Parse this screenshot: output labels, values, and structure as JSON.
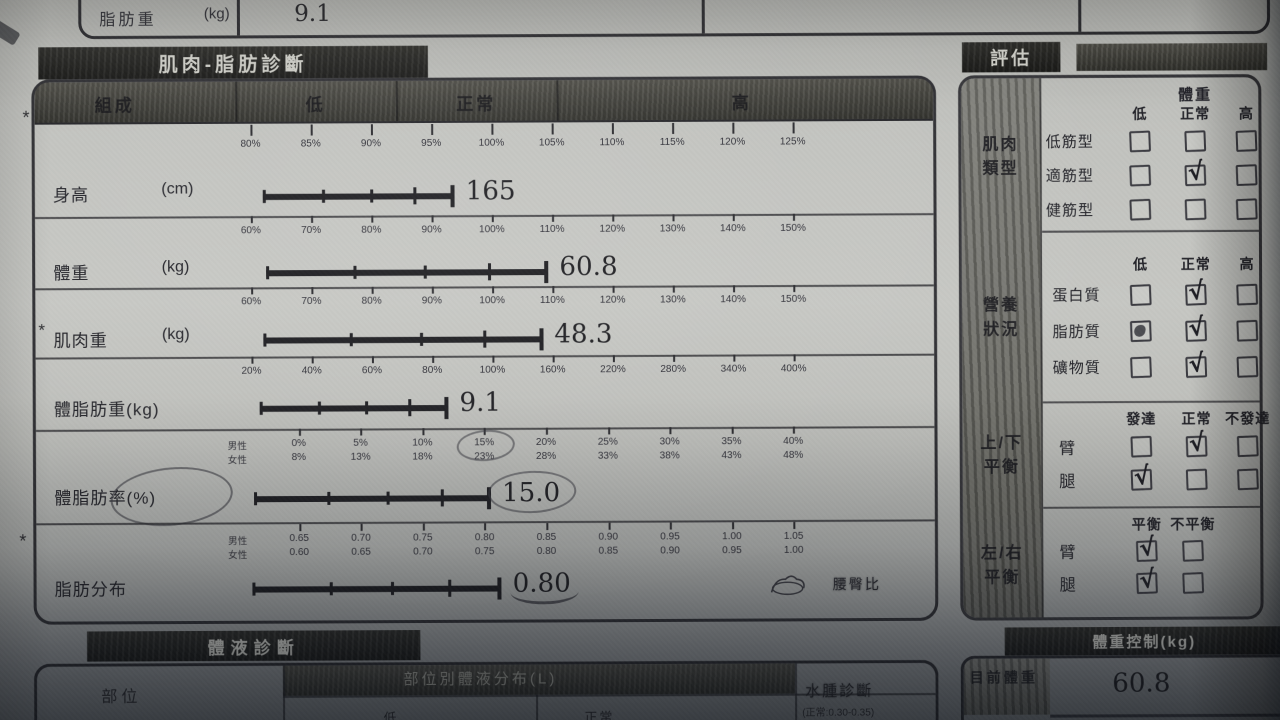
{
  "colors": {
    "paper": "#c4c5c1",
    "band": "#2a2a27",
    "ink": "#222226",
    "check_ink": "#1e1e24"
  },
  "margin_stars": [
    "*",
    "*"
  ],
  "top_row": {
    "label": "脂肪重",
    "unit": "(kg)",
    "value": "9.1"
  },
  "muscle_fat": {
    "tab_title": "肌肉-脂肪診斷",
    "header_cols": [
      "組成",
      "低",
      "正常",
      "高"
    ],
    "rows": [
      {
        "label": "身高",
        "unit": "(cm)",
        "value": "165",
        "scales": [
          {
            "prefix": "",
            "ticks": [
              "80%",
              "85%",
              "90%",
              "95%",
              "100%",
              "105%",
              "110%",
              "115%",
              "120%",
              "125%"
            ]
          }
        ],
        "bar": {
          "start": 7,
          "end": 38.7
        }
      },
      {
        "label": "體重",
        "unit": "(kg)",
        "value": "60.8",
        "scales": [
          {
            "prefix": "",
            "ticks": [
              "60%",
              "70%",
              "80%",
              "90%",
              "100%",
              "110%",
              "120%",
              "130%",
              "140%",
              "150%"
            ]
          }
        ],
        "bar": {
          "start": 7.5,
          "end": 54.2
        }
      },
      {
        "label": "肌肉重",
        "unit": "(kg)",
        "value": "48.3",
        "star": "*",
        "scales": [
          {
            "prefix": "",
            "ticks": [
              "60%",
              "70%",
              "80%",
              "90%",
              "100%",
              "110%",
              "120%",
              "130%",
              "140%",
              "150%"
            ]
          }
        ],
        "bar": {
          "start": 7,
          "end": 53.3
        }
      },
      {
        "label": "體脂肪重(kg)",
        "unit": "",
        "value": "9.1",
        "scales": [
          {
            "prefix": "",
            "ticks": [
              "20%",
              "40%",
              "60%",
              "80%",
              "100%",
              "160%",
              "220%",
              "280%",
              "340%",
              "400%"
            ]
          }
        ],
        "bar": {
          "start": 6.3,
          "end": 37.5
        }
      },
      {
        "label": "體脂肪率(%)",
        "unit": "",
        "value": "15.0",
        "label_circled": true,
        "value_circled": true,
        "scales": [
          {
            "prefix": "男性",
            "circled": 3,
            "ticks": [
              "0%",
              "5%",
              "10%",
              "15%",
              "20%",
              "25%",
              "30%",
              "35%",
              "40%"
            ]
          },
          {
            "prefix": "女性",
            "ticks": [
              "8%",
              "13%",
              "18%",
              "23%",
              "28%",
              "33%",
              "38%",
              "43%",
              "48%"
            ]
          }
        ],
        "bar": {
          "start": 5.3,
          "end": 44.5
        }
      },
      {
        "label": "脂肪分布",
        "unit": "",
        "value": "0.80",
        "value_underlined": true,
        "trailing_label": "腰臀比",
        "scales": [
          {
            "prefix": "男性",
            "ticks": [
              "0.65",
              "0.70",
              "0.75",
              "0.80",
              "0.85",
              "0.90",
              "0.95",
              "1.00",
              "1.05"
            ]
          },
          {
            "prefix": "女性",
            "ticks": [
              "0.60",
              "0.65",
              "0.70",
              "0.75",
              "0.80",
              "0.85",
              "0.90",
              "0.95",
              "1.00"
            ]
          }
        ],
        "bar": {
          "start": 5,
          "end": 46.2
        }
      }
    ]
  },
  "evaluation": {
    "tab_title": "評估",
    "check_glyph": "√",
    "sections": [
      {
        "side_label": [
          "肌肉",
          "類型"
        ],
        "super_header": "體重",
        "columns": [
          "低",
          "正常",
          "高"
        ],
        "rows": [
          {
            "label": "低筋型",
            "cells": [
              "empty",
              "empty",
              "empty"
            ]
          },
          {
            "label": "適筋型",
            "cells": [
              "empty",
              "check",
              "empty"
            ]
          },
          {
            "label": "健筋型",
            "cells": [
              "empty",
              "empty",
              "empty"
            ]
          }
        ]
      },
      {
        "side_label": [
          "營養",
          "狀況"
        ],
        "columns": [
          "低",
          "正常",
          "高"
        ],
        "rows": [
          {
            "label": "蛋白質",
            "cells": [
              "empty",
              "check",
              "empty"
            ]
          },
          {
            "label": "脂肪質",
            "cells": [
              "smudge",
              "check",
              "empty"
            ]
          },
          {
            "label": "礦物質",
            "cells": [
              "empty",
              "check",
              "empty"
            ]
          }
        ]
      },
      {
        "side_label": [
          "上/下",
          "平衡"
        ],
        "columns": [
          "發達",
          "正常",
          "不發達"
        ],
        "rows": [
          {
            "label": "臂",
            "cells": [
              "empty",
              "check",
              "empty"
            ]
          },
          {
            "label": "腿",
            "cells": [
              "check",
              "empty",
              "empty"
            ]
          }
        ]
      },
      {
        "side_label": [
          "左/右",
          "平衡"
        ],
        "columns": [
          "平衡",
          "不平衡"
        ],
        "rows": [
          {
            "label": "臂",
            "cells": [
              "check",
              "empty"
            ]
          },
          {
            "label": "腿",
            "cells": [
              "check",
              "empty"
            ]
          }
        ]
      }
    ]
  },
  "body_fluid": {
    "tab_title": "體液診斷",
    "col_part": "部位",
    "col_distribution": "部位別體液分布(L)",
    "sub_cols": [
      "低",
      "正常"
    ],
    "edema_label": "水腫診斷",
    "edema_range": "(正常:0.30-0.35)"
  },
  "weight_control": {
    "tab_title": "體重控制(kg)",
    "row_label": "目前體重",
    "row_value": "60.8"
  }
}
